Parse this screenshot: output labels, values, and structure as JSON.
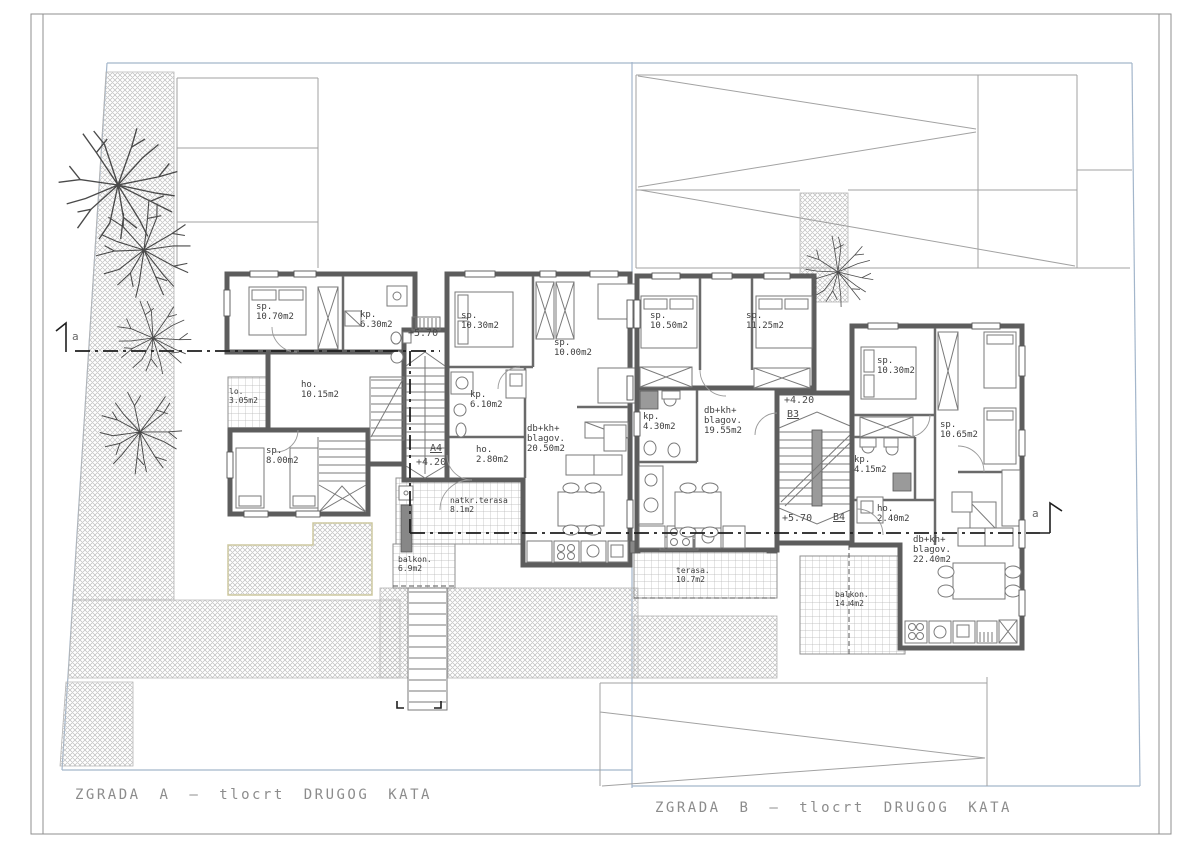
{
  "drawing": {
    "title_a": "ZGRADA A — tlocrt DRUGOG KATA",
    "title_b": "ZGRADA B — tlocrt DRUGOG KATA"
  },
  "section_markers": {
    "left": "a",
    "right": "a"
  },
  "stairs": {
    "a": {
      "upper_level": "+5.70",
      "id": "A4",
      "lower_level": "+4.20"
    },
    "b_upper": {
      "level": "+4.20",
      "id": "B3"
    },
    "b_lower": {
      "level": "+5.70",
      "id": "B4"
    }
  },
  "building_a": {
    "unit1_rooms": {
      "sp1": {
        "name": "sp.",
        "area": "10.70m2"
      },
      "kp": {
        "name": "kp.",
        "area": "6.30m2"
      },
      "lo": {
        "name": "lo.",
        "area": "3.05m2"
      },
      "ho": {
        "name": "ho.",
        "area": "10.15m2"
      },
      "sp2": {
        "name": "sp.",
        "area": "8.00m2"
      }
    },
    "unit2_rooms": {
      "sp1": {
        "name": "sp.",
        "area": "10.30m2"
      },
      "sp2": {
        "name": "sp.",
        "area": "10.00m2"
      },
      "kp": {
        "name": "kp.",
        "area": "6.10m2"
      },
      "ho": {
        "name": "ho.",
        "area": "2.80m2"
      },
      "living": {
        "name": "db+kh+",
        "name2": "blagov.",
        "area": "20.50m2"
      },
      "terrace": {
        "name": "natkr.terasa",
        "area": "8.1m2"
      },
      "balcony": {
        "name": "balkon.",
        "area": "6.9m2"
      }
    }
  },
  "building_b": {
    "unit1_rooms": {
      "sp1": {
        "name": "sp.",
        "area": "10.50m2"
      },
      "sp2": {
        "name": "sp.",
        "area": "11.25m2"
      },
      "kp": {
        "name": "kp.",
        "area": "4.30m2"
      },
      "living": {
        "name": "db+kh+",
        "name2": "blagov.",
        "area": "19.55m2"
      },
      "terrace": {
        "name": "terasa.",
        "area": "10.7m2"
      }
    },
    "unit2_rooms": {
      "sp1": {
        "name": "sp.",
        "area": "10.30m2"
      },
      "sp2": {
        "name": "sp.",
        "area": "10.65m2"
      },
      "kp": {
        "name": "kp.",
        "area": "4.15m2"
      },
      "ho": {
        "name": "ho.",
        "area": "2.40m2"
      },
      "living": {
        "name": "db+kh+",
        "name2": "blagov.",
        "area": "22.40m2"
      },
      "balcony": {
        "name": "balkon.",
        "area": "14.4m2"
      }
    }
  },
  "colors": {
    "boundary_blue": "#a3b6cb",
    "wall_gray": "#5d5d5d",
    "hatch_gray": "#b5b5b5",
    "text_gray": "#8c8c8c"
  }
}
